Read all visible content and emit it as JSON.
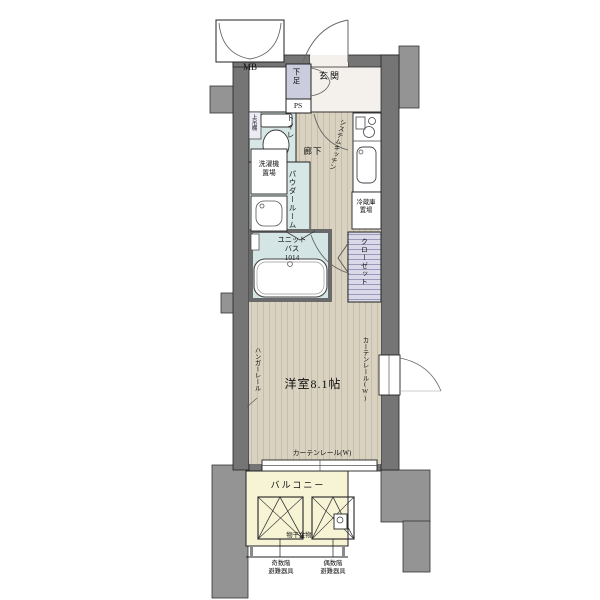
{
  "entrance": {
    "mb": "MB",
    "genkan": "玄関",
    "shoe_box": "下足",
    "ps": "PS"
  },
  "sanitary": {
    "toilet": "トイレ",
    "upper_shelf": "上吊棚",
    "washer_line1": "洗濯機",
    "washer_line2": "置場",
    "powder_room": "パウダールーム",
    "unit_bath_line1": "ユニット",
    "unit_bath_line2": "バス",
    "unit_bath_line3": "1014"
  },
  "kitchen": {
    "system_kitchen": "システムキッチン",
    "fridge_line1": "冷蔵庫",
    "fridge_line2": "置場"
  },
  "hall": {
    "hallway": "廊下",
    "closet": "クローゼット"
  },
  "room": {
    "name": "洋室8.1帖",
    "hanger_rail": "ハンガーレール",
    "curtain_rail_right": "カーテンレール(W)",
    "curtain_rail_bottom": "カーテンレール(W)"
  },
  "balcony": {
    "name": "バルコニー",
    "laundry_hardware": "物干金物",
    "evac_odd_line1": "奇数階",
    "evac_odd_line2": "避難器具",
    "evac_even_line1": "偶数階",
    "evac_even_line2": "避難器具"
  },
  "colors": {
    "wall": "#757575",
    "outer_block": "#949494",
    "wood_floor": "#d9d2c1",
    "wet_area": "#d7e7e6",
    "closet_fill": "#d9d9ea",
    "balcony_floor": "#f7f4d6",
    "genkan_floor": "#f4f1ec",
    "lavender_box": "#ccccdf"
  }
}
